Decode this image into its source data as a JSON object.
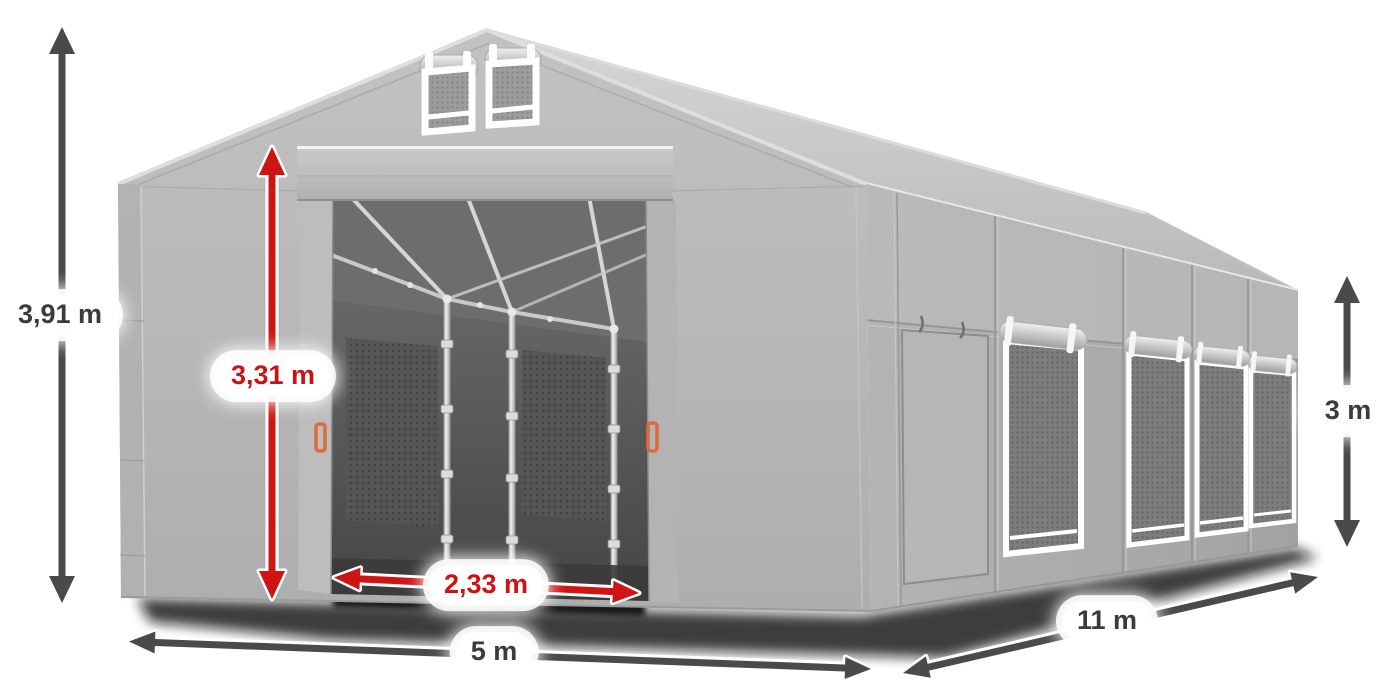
{
  "page": {
    "background_color": "#ffffff",
    "description": "Dimensioned product illustration of a grey storage marquee tent"
  },
  "annotations": {
    "total_height": {
      "label": "3,91 m",
      "style": "dark"
    },
    "entrance_height": {
      "label": "3,31 m",
      "style": "red"
    },
    "entrance_width": {
      "label": "2,33 m",
      "style": "red"
    },
    "front_width": {
      "label": "5 m",
      "style": "dark"
    },
    "side_length": {
      "label": "11 m",
      "style": "dark"
    },
    "side_wall_height": {
      "label": "3 m",
      "style": "dark"
    }
  },
  "colors": {
    "dark_arrow": "#4a4a4a",
    "red_arrow": "#cf1414",
    "dark_label_text": "#3b3b3b",
    "red_label_text": "#cc1212",
    "label_background": "#ffffff",
    "tent_fabric": "#b7b7b7",
    "tent_roof": "#cccccc",
    "tent_interior": "#565656",
    "frame_poles": "#d9d9d9",
    "handle_orange": "#dd6a3e"
  }
}
